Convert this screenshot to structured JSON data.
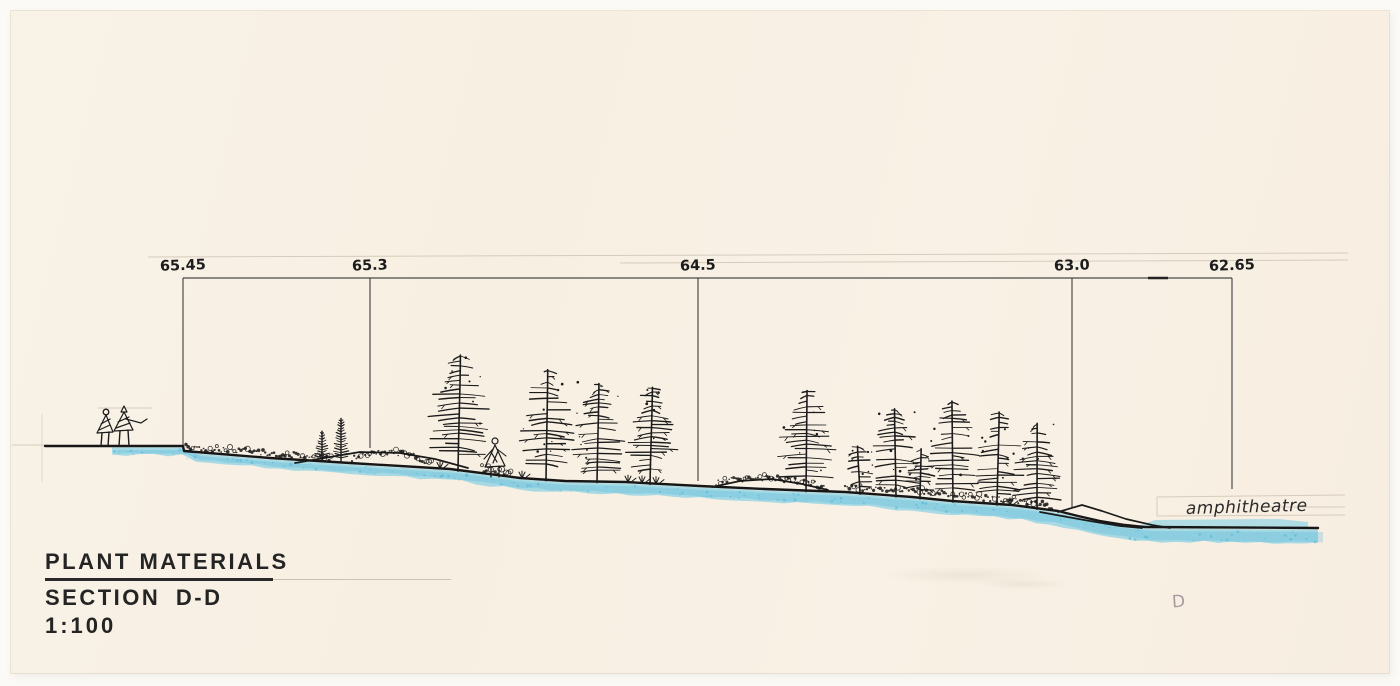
{
  "document": {
    "title_block": {
      "line1": "PLANT MATERIALS",
      "line2": "SECTION D-D",
      "scale": "1:100"
    },
    "annotations": {
      "amphitheatre": "amphitheatre",
      "sheet_mark": "D"
    },
    "colors": {
      "ink": "#1b1b1b",
      "datum_line": "#4a4a4a",
      "marker_blue": "#4fc1e4",
      "marker_blue_dark": "#2fa8d4",
      "pencil": "#d6ccbd",
      "paper": "#f8f0e5"
    }
  },
  "drawing": {
    "datum": {
      "y": 278,
      "x1": 183,
      "x2": 1232
    },
    "datum_overstroke": {
      "x1": 1148,
      "x2": 1168
    },
    "pencil_guides": [
      {
        "x1": 148,
        "y1": 257,
        "x2": 1348,
        "y2": 253
      },
      {
        "x1": 620,
        "y1": 263,
        "x2": 1348,
        "y2": 260
      },
      {
        "x1": 12,
        "y1": 445,
        "x2": 48,
        "y2": 445
      },
      {
        "x1": 98,
        "y1": 408,
        "x2": 152,
        "y2": 408
      }
    ],
    "elevation_markers": [
      {
        "label": "65.45",
        "x": 183,
        "line_end_y": 446
      },
      {
        "label": "65.3",
        "x": 370,
        "line_end_y": 448
      },
      {
        "label": "64.5",
        "x": 698,
        "line_end_y": 481
      },
      {
        "label": "63.0",
        "x": 1072,
        "line_end_y": 508
      },
      {
        "label": "62.65",
        "x": 1232,
        "line_end_y": 489
      }
    ],
    "ground_profile": [
      [
        45,
        446
      ],
      [
        183,
        446
      ],
      [
        184,
        451
      ],
      [
        270,
        458
      ],
      [
        350,
        463
      ],
      [
        450,
        469
      ],
      [
        520,
        478
      ],
      [
        565,
        481
      ],
      [
        625,
        482
      ],
      [
        700,
        486
      ],
      [
        765,
        489
      ],
      [
        845,
        492
      ],
      [
        912,
        497
      ],
      [
        952,
        501
      ],
      [
        1012,
        505
      ],
      [
        1058,
        511
      ],
      [
        1078,
        516
      ],
      [
        1100,
        521
      ],
      [
        1125,
        525
      ],
      [
        1145,
        527
      ],
      [
        1318,
        528
      ]
    ],
    "water_band": {
      "start": 112,
      "end": 1318,
      "upper_band_x1": 1135,
      "upper_band_x2": 1308
    },
    "berms": [
      [
        [
          295,
          463
        ],
        [
          330,
          457
        ],
        [
          360,
          452
        ],
        [
          400,
          453
        ],
        [
          435,
          459
        ],
        [
          468,
          468
        ]
      ],
      [
        [
          712,
          487
        ],
        [
          740,
          481
        ],
        [
          772,
          479
        ],
        [
          802,
          484
        ],
        [
          828,
          490
        ]
      ],
      [
        [
          1058,
          512
        ],
        [
          1082,
          505
        ],
        [
          1102,
          511
        ],
        [
          1126,
          519
        ],
        [
          1152,
          525
        ],
        [
          1170,
          528
        ]
      ],
      [
        [
          1040,
          512
        ],
        [
          1062,
          516
        ],
        [
          1090,
          521
        ],
        [
          1120,
          526
        ],
        [
          1142,
          528
        ]
      ]
    ],
    "shrub_spans": [
      {
        "x1": 186,
        "x2": 332,
        "lift": 1
      },
      {
        "x1": 352,
        "x2": 432,
        "lift": 9
      },
      {
        "x1": 482,
        "x2": 512,
        "lift": 0
      },
      {
        "x1": 716,
        "x2": 828,
        "lift": 7
      },
      {
        "x1": 845,
        "x2": 1005,
        "lift": 3
      },
      {
        "x1": 1005,
        "x2": 1052,
        "lift": 1
      }
    ],
    "grass_tufts": [
      440,
      522,
      628,
      642,
      656,
      1010
    ],
    "trees": [
      {
        "x": 322,
        "h": 30,
        "w": 15,
        "type": "conifer"
      },
      {
        "x": 341,
        "h": 44,
        "w": 19,
        "type": "conifer"
      },
      {
        "x": 458,
        "h": 118,
        "w": 46,
        "type": "larch"
      },
      {
        "x": 546,
        "h": 113,
        "w": 42,
        "type": "larch"
      },
      {
        "x": 597,
        "h": 101,
        "w": 38,
        "type": "larch"
      },
      {
        "x": 650,
        "h": 99,
        "w": 38,
        "type": "larch"
      },
      {
        "x": 806,
        "h": 103,
        "w": 42,
        "type": "larch"
      },
      {
        "x": 860,
        "h": 50,
        "w": 24,
        "type": "larch"
      },
      {
        "x": 896,
        "h": 90,
        "w": 36,
        "type": "larch"
      },
      {
        "x": 920,
        "h": 52,
        "w": 24,
        "type": "larch"
      },
      {
        "x": 953,
        "h": 103,
        "w": 40,
        "type": "larch"
      },
      {
        "x": 997,
        "h": 95,
        "w": 38,
        "type": "larch"
      },
      {
        "x": 1037,
        "h": 88,
        "w": 36,
        "type": "larch"
      }
    ],
    "amphitheatre_guides": {
      "x1": 1157,
      "x2": 1345,
      "y_top": 497,
      "y_bottom": 516,
      "y_mid": 507,
      "mid_x1": 1270
    },
    "amphitheatre_pos": {
      "x": 1186,
      "y": 514
    },
    "label_y": 270
  }
}
